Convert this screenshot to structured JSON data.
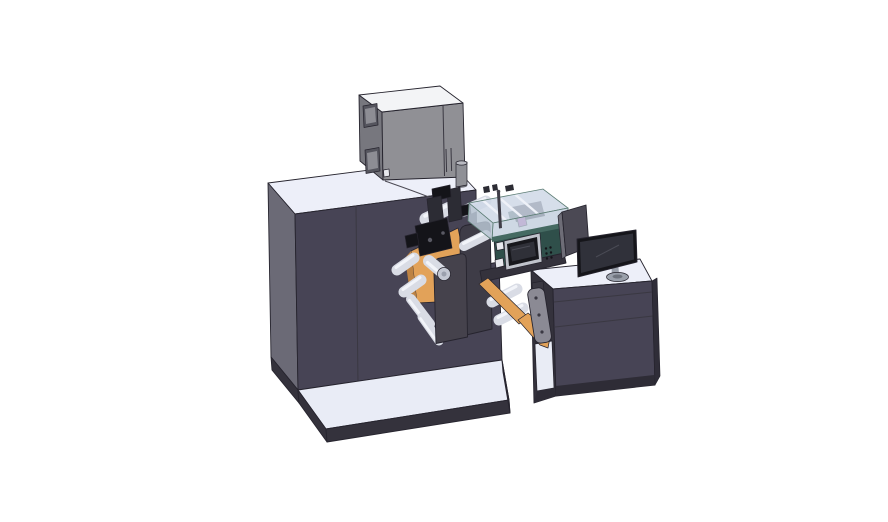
{
  "canvas": {
    "width": 888,
    "height": 522
  },
  "scene": {
    "description": "CAD-style 3D render of a roll-fed label printing press with web rollers, print mechanism, clear safety cover, HMI panel and an operator desk with monitor",
    "background": "#ffffff"
  },
  "colors": {
    "background": "#ffffff",
    "outline": "#26242e",
    "machine_front": "#474455",
    "machine_side": "#6b6a76",
    "machine_top": "#edeff9",
    "machine_dark": "#34323c",
    "seam": "#3a3842",
    "platform_top": "#e9ecf6",
    "platform_side": "#34323c",
    "plinth": "#2e2c36",
    "graybox_front": "#909095",
    "graybox_side": "#77777e",
    "graybox_top": "#f3f4f6",
    "graybox_window": "#55555e",
    "graybox_window_inner": "#8d8d94",
    "graybox_detail": "#e8e9ee",
    "cylinder": "#8f9096",
    "cylinder_top": "#b9bac1",
    "cylinder_base": "#6f6f78",
    "teal_front": "#2f4f4a",
    "teal_frame": "#456a62",
    "screen_frame": "#c0c3cb",
    "screen_bezel": "#17171c",
    "screen_face": "#2f3038",
    "screen_glint": "#4a4b55",
    "cover_glass": "#cdd7e5",
    "cover_glass_front": "#c2cedd",
    "cover_glass_side": "#b9c5d4",
    "cover_rail": "#eef1f8",
    "cover_inner": "#3a3a44",
    "magenta": "#c362be",
    "orange": "#e2a259",
    "orange_dark": "#bd8344",
    "roller": "#d9dce5",
    "roller_hi": "#f2f4f9",
    "roller_end": "#c3c7d2",
    "roller_core": "#9ba0ad",
    "mech_black": "#141419",
    "mech_gray": "#2c2c34",
    "mech_light": "#595963",
    "stand_plate": "#3e3c47",
    "stand_plate_front": "#45424c",
    "bracket": "#8b8a94",
    "bracket_dark": "#3a3842",
    "desk_front": "#474455",
    "desk_side": "#2f2d38",
    "desk_top": "#edeff9",
    "desk_cavity": "#e9ecf5",
    "monitor_bezel": "#15151a",
    "monitor_face": "#30313a",
    "monitor_stand": "#9aa0ab",
    "monitor_stand_dark": "#6e737d",
    "panel_back": "#4b4954",
    "panel_edge": "#6e6d77",
    "rod": "#3f3d47",
    "wire": "#4c4a54"
  },
  "parts": [
    {
      "id": "machine-cabinet"
    },
    {
      "id": "base-platform"
    },
    {
      "id": "electrical-enclosure"
    },
    {
      "id": "exhaust-filter-cylinder"
    },
    {
      "id": "print-head-mechanism"
    },
    {
      "id": "unwind-web-roll"
    },
    {
      "id": "web-rollers"
    },
    {
      "id": "roller-stand-plates"
    },
    {
      "id": "hmi-control-panel"
    },
    {
      "id": "clear-safety-cover"
    },
    {
      "id": "ink-cartridge"
    },
    {
      "id": "edge-sensor-rod"
    },
    {
      "id": "web-guide-bracket"
    },
    {
      "id": "operator-desk"
    },
    {
      "id": "desk-shelf-cavity"
    },
    {
      "id": "desktop-monitor"
    },
    {
      "id": "rear-display-panel"
    }
  ]
}
